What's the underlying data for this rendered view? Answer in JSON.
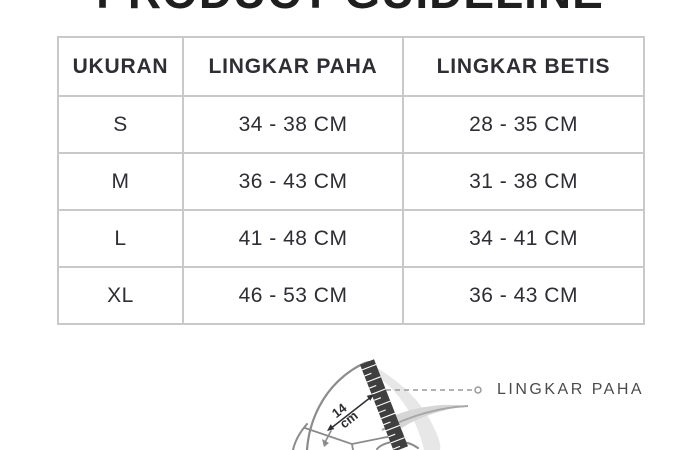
{
  "page": {
    "title": "PRODUCT GUIDELINE",
    "background_color": "#ffffff",
    "title_color": "#1f1f1f"
  },
  "table": {
    "headers": [
      "UKURAN",
      "LINGKAR PAHA",
      "LINGKAR BETIS"
    ],
    "rows": [
      {
        "size": "S",
        "paha": "34 - 38 CM",
        "betis": "28 - 35 CM"
      },
      {
        "size": "M",
        "paha": "36 - 43 CM",
        "betis": "31 - 38 CM"
      },
      {
        "size": "L",
        "paha": "41 - 48 CM",
        "betis": "34 - 41 CM"
      },
      {
        "size": "XL",
        "paha": "46 - 53 CM",
        "betis": "36 - 43 CM"
      }
    ],
    "border_color": "#c9c9c9",
    "text_color": "#2e2e34"
  },
  "diagram": {
    "label_thigh": "LINGKAR PAHA",
    "length_value": "14",
    "length_unit": "cm",
    "tape_color": "#3f3f3f",
    "outline_color": "#8b8b8b",
    "leader_color": "#9a9a9a"
  }
}
